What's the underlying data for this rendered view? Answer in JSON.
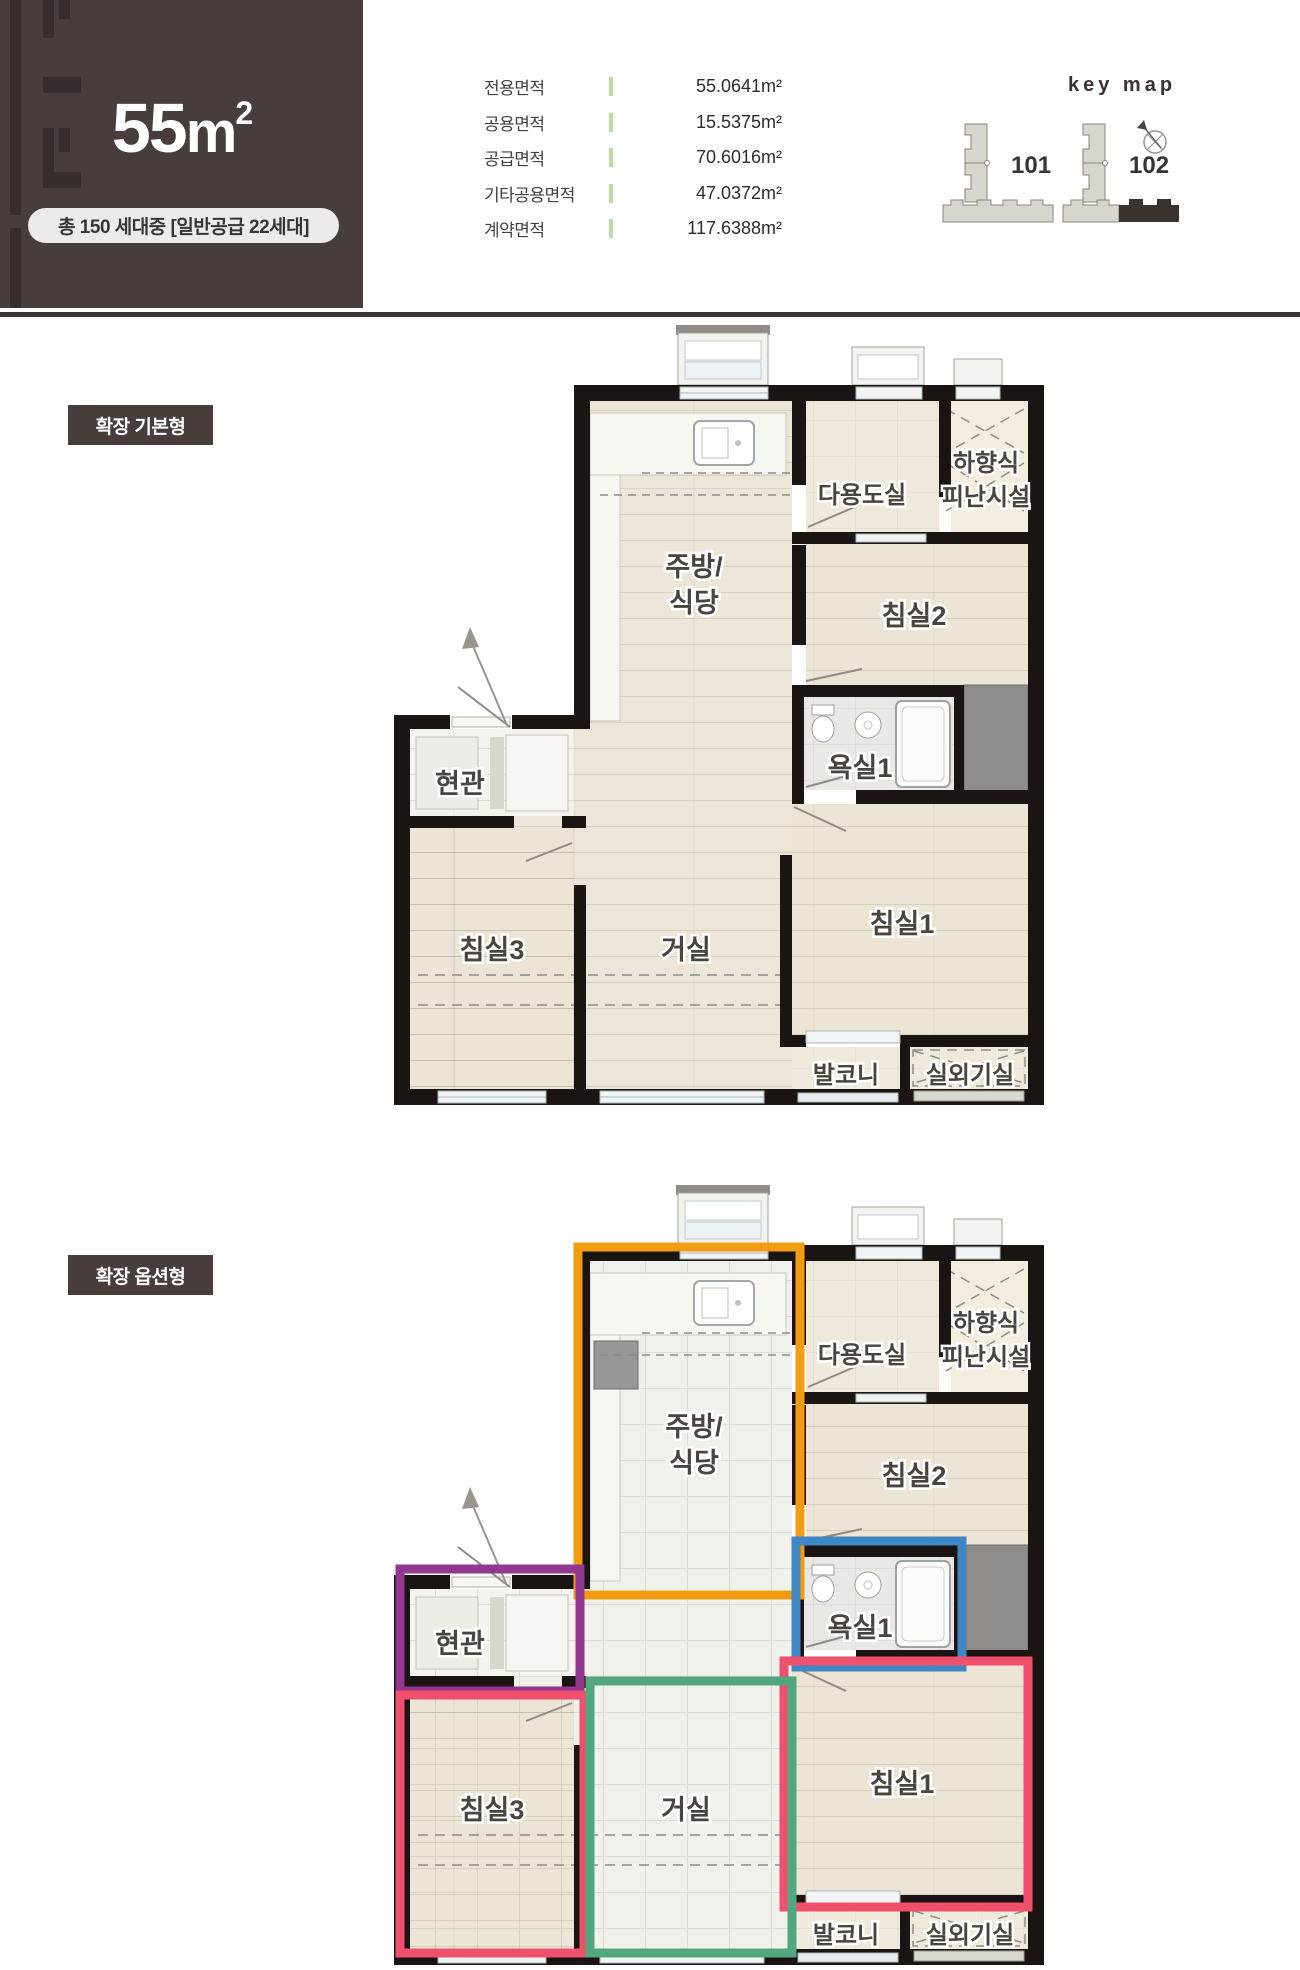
{
  "page": {
    "bg": "#FFFFFF",
    "brand_dark": "#473E3B",
    "divider_green": "#BCDCA6"
  },
  "header": {
    "title": {
      "num": "55",
      "unit": "m",
      "sup": "2"
    },
    "badge": "총 150 세대중 [일반공급 22세대]",
    "area_table": {
      "rows": [
        {
          "label": "전용면적",
          "value": "55.0641m²"
        },
        {
          "label": "공용면적",
          "value": "15.5375m²"
        },
        {
          "label": "공급면적",
          "value": "70.6016m²"
        },
        {
          "label": "기타공용면적",
          "value": "47.0372m²"
        },
        {
          "label": "계약면적",
          "value": "117.6388m²"
        }
      ]
    },
    "keymap": {
      "title": "key map",
      "building_101": "101",
      "building_102": "102"
    }
  },
  "sections": {
    "basic": {
      "tag": "확장 기본형"
    },
    "option": {
      "tag": "확장 옵션형"
    }
  },
  "rooms": {
    "kitchen_line1": "주방/",
    "kitchen_line2": "식당",
    "utility": "다용도실",
    "evac_line1": "하향식",
    "evac_line2": "피난시설",
    "bedroom2": "침실2",
    "bath1": "욕실1",
    "entrance": "현관",
    "bedroom3": "침실3",
    "living": "거실",
    "bedroom1": "침실1",
    "balcony": "발코니",
    "ac_room": "실외기실"
  },
  "option_zone_colors": {
    "kitchen": "#F29C13",
    "entrance": "#93388F",
    "bath": "#3F86C5",
    "bedroom": "#F0506B",
    "living": "#53A77F"
  }
}
